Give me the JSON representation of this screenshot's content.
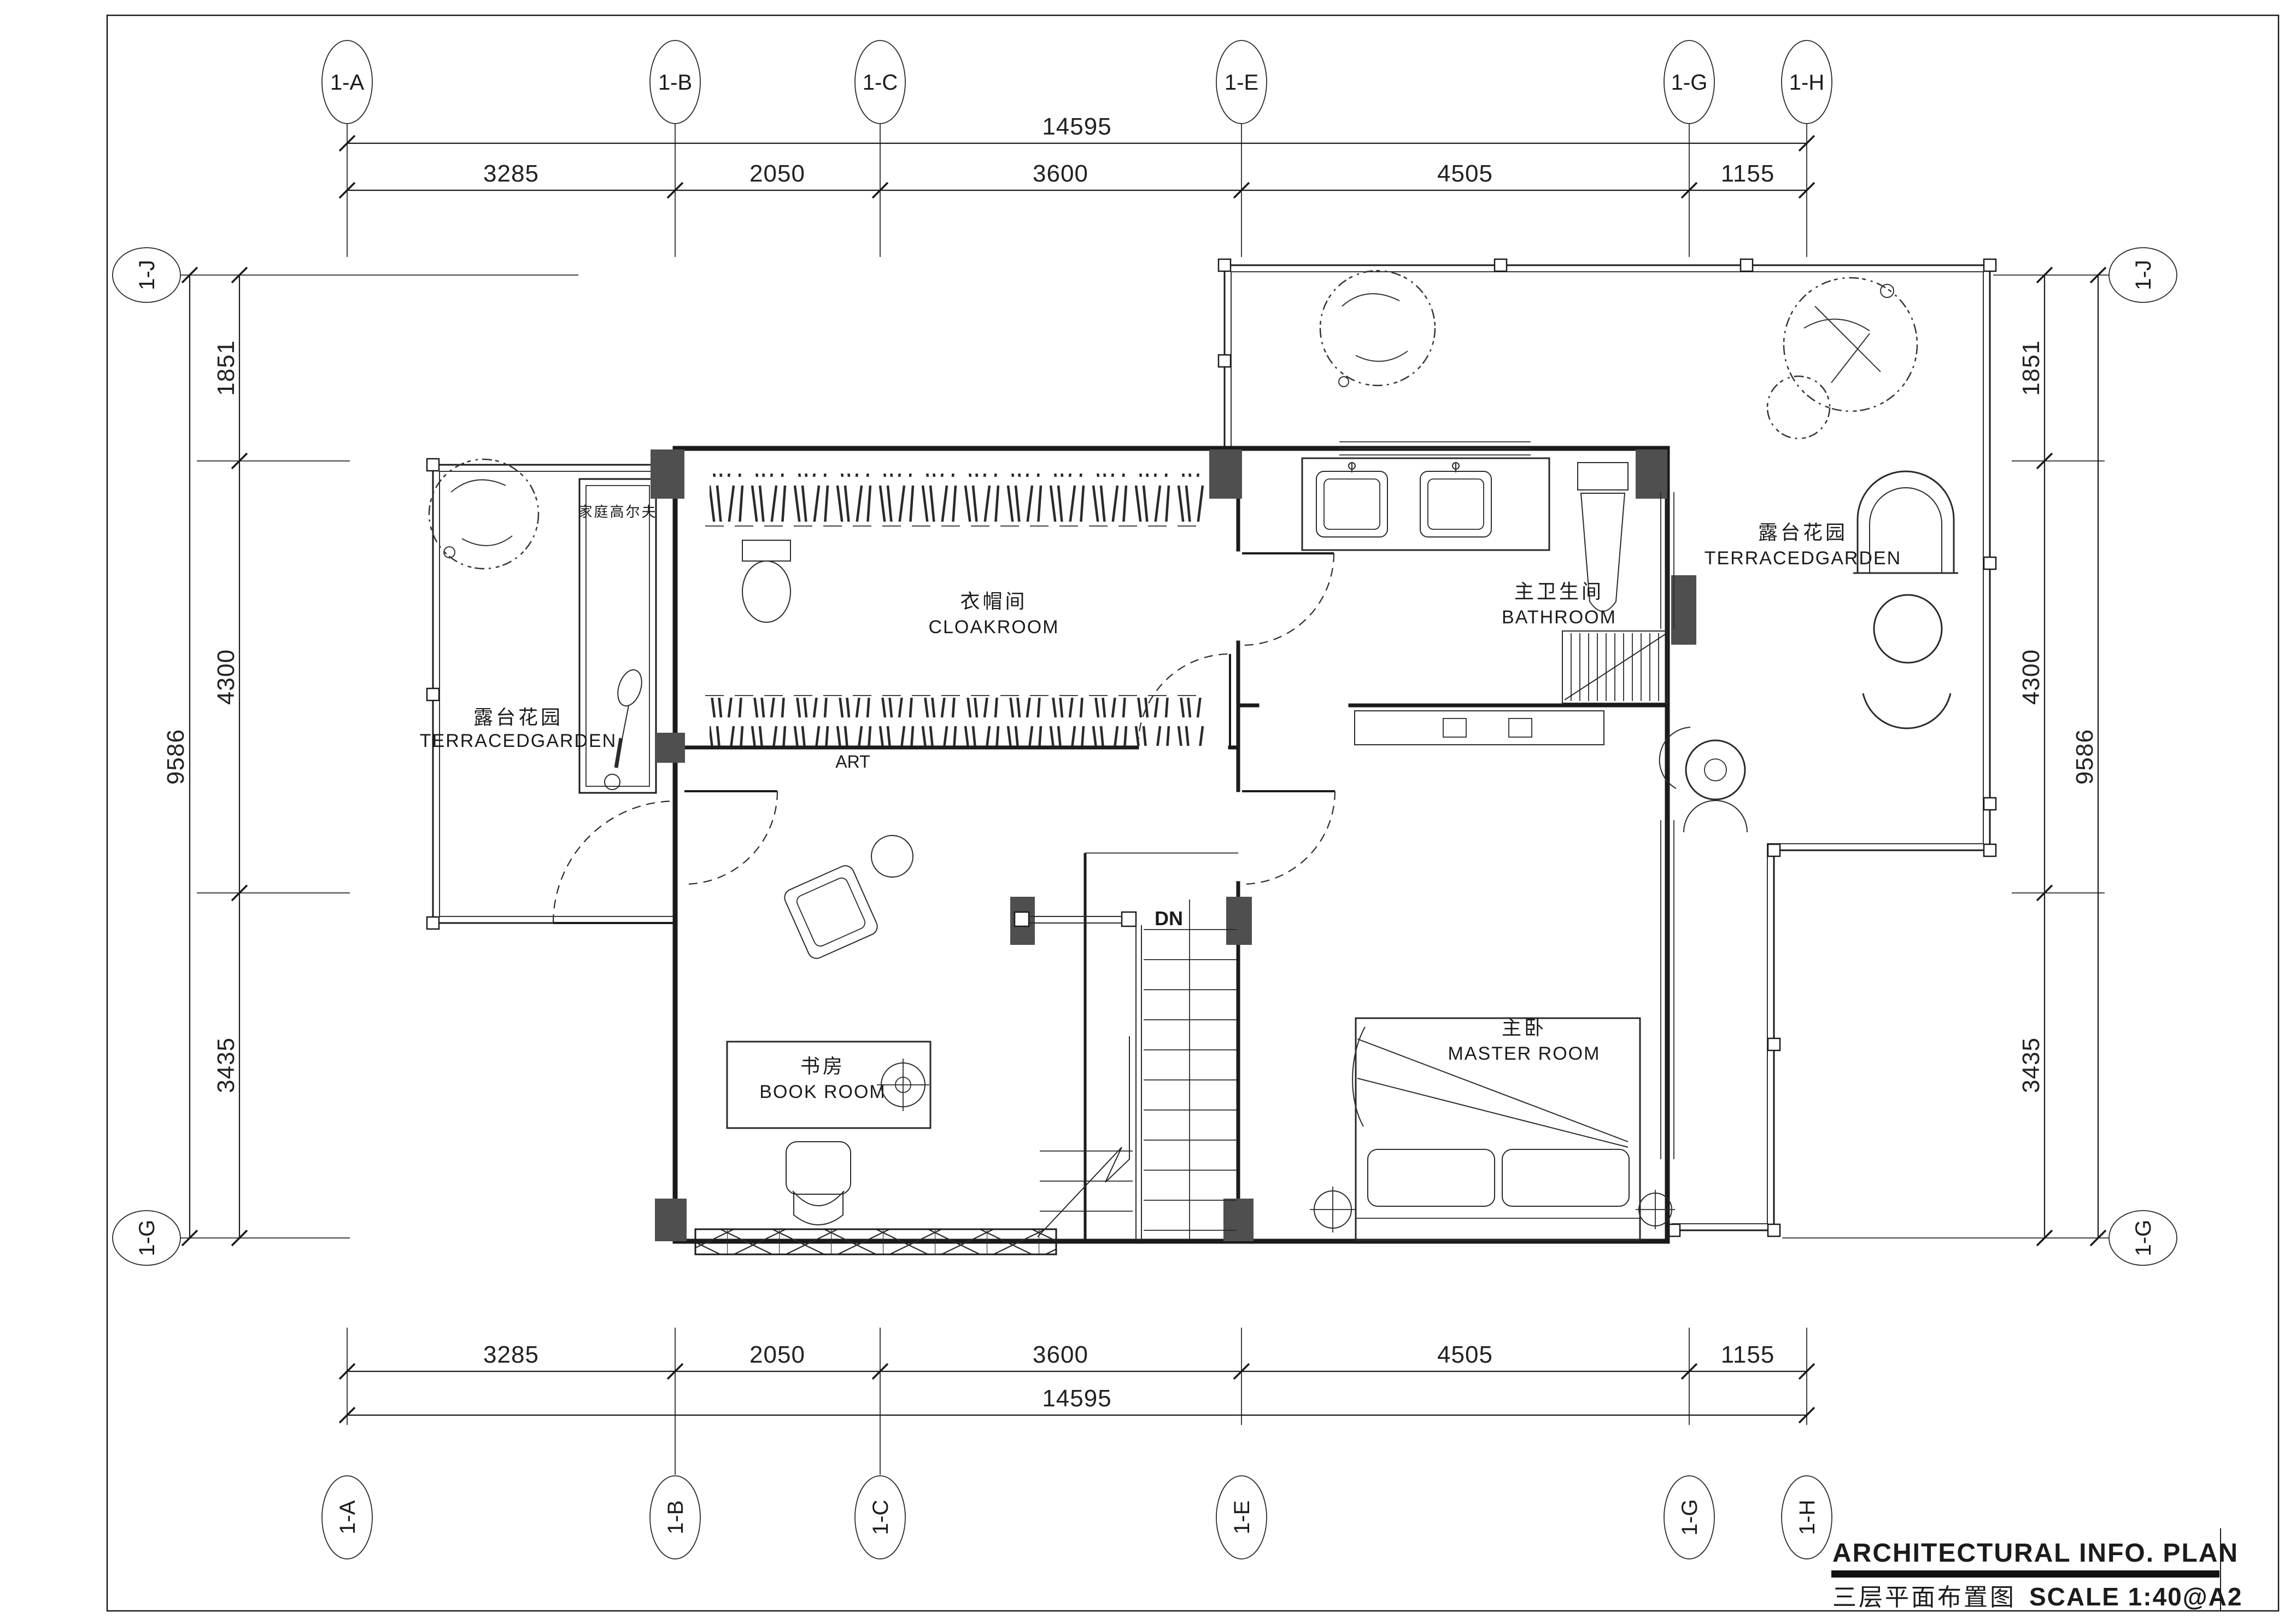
{
  "sheet": {
    "title_en": "ARCHITECTURAL  INFO. PLAN",
    "title_cn": "三层平面布置图",
    "scale": "SCALE  1:40@A2"
  },
  "axes": {
    "top": [
      "1-A",
      "1-B",
      "1-C",
      "1-E",
      "1-G",
      "1-H"
    ],
    "bottom": [
      "1-A",
      "1-B",
      "1-C",
      "1-E",
      "1-G",
      "1-H"
    ],
    "left": [
      "1-J",
      "1-G"
    ],
    "right": [
      "1-J",
      "1-G"
    ]
  },
  "dims": {
    "h_total": "14595",
    "h_segs": [
      "3285",
      "2050",
      "3600",
      "4505",
      "1155"
    ],
    "v_total": "9586",
    "v_segs": [
      "1851",
      "4300",
      "3435"
    ]
  },
  "rooms": {
    "cloakroom": {
      "cn": "衣帽间",
      "en": "CLOAKROOM"
    },
    "bathroom": {
      "cn": "主卫生间",
      "en": "BATHROOM"
    },
    "bookroom": {
      "cn": "书房",
      "en": "BOOK ROOM"
    },
    "master": {
      "cn": "主卧",
      "en": "MASTER ROOM"
    },
    "terrace_left": {
      "cn": "露台花园",
      "en": "TERRACEDGARDEN"
    },
    "terrace_right": {
      "cn": "露台花园",
      "en": "TERRACEDGARDEN"
    },
    "golf": {
      "cn": "家庭高尔夫"
    }
  },
  "annotations": {
    "art": "ART",
    "down": "DN"
  },
  "colors": {
    "line": "#1b1b1b",
    "column_fill": "#4f4f4f",
    "paper": "#ffffff"
  }
}
